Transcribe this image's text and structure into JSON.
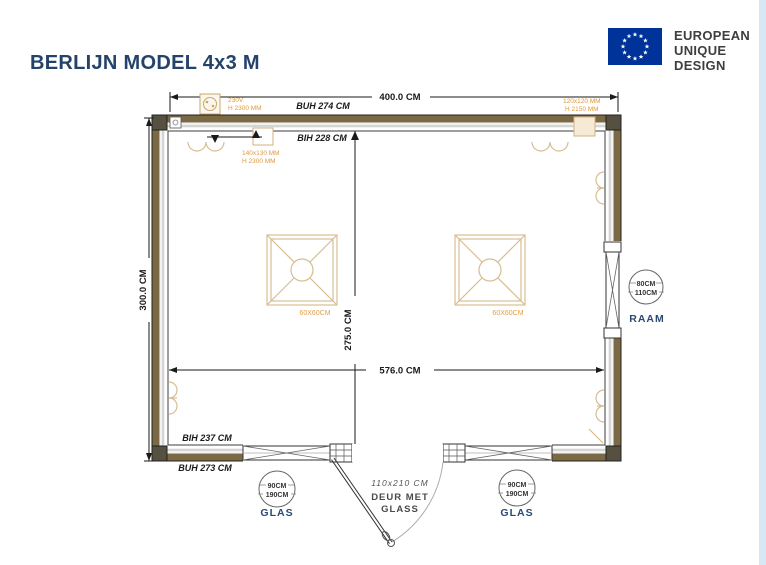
{
  "header": {
    "title": "BERLIJN MODEL 4x3 M",
    "logo": {
      "line1": "EUROPEAN",
      "line2": "UNIQUE",
      "line3": "DESIGN"
    }
  },
  "plan": {
    "outer_width": "400.0 CM",
    "outer_height": "300.0 CM",
    "inner_width": "576.0 CM",
    "inner_height": "275.0 CM",
    "buh_top": "BUH 274 CM",
    "bih_top": "BIH 228 CM",
    "bih_bottom": "BIH 237 CM",
    "buh_bottom": "BUH 273 CM",
    "power": {
      "volts": "230V",
      "height": "H 2300 MM"
    },
    "vent_left": {
      "size": "140x130 MM",
      "height": "H 2300 MM"
    },
    "vent_right": {
      "size": "120x120 MM",
      "height": "H 2150 MM"
    },
    "skylights": [
      {
        "label": "60X60CM"
      },
      {
        "label": "60X60CM"
      }
    ],
    "window_right": {
      "size1": "80CM",
      "size2": "110CM",
      "label": "RAAM"
    },
    "windows_bottom": [
      {
        "size1": "90CM",
        "size2": "190CM",
        "label": "GLAS"
      },
      {
        "size1": "90CM",
        "size2": "190CM",
        "label": "GLAS"
      }
    ],
    "door": {
      "size": "110x210 CM",
      "label_line1": "DEUR MET",
      "label_line2": "GLASS"
    }
  },
  "colors": {
    "eu_blue": "#003399",
    "navy": "#24436b",
    "wall_brown": "#7b6844",
    "accent_orange": "#e09a3c",
    "tan": "#d2b283"
  }
}
